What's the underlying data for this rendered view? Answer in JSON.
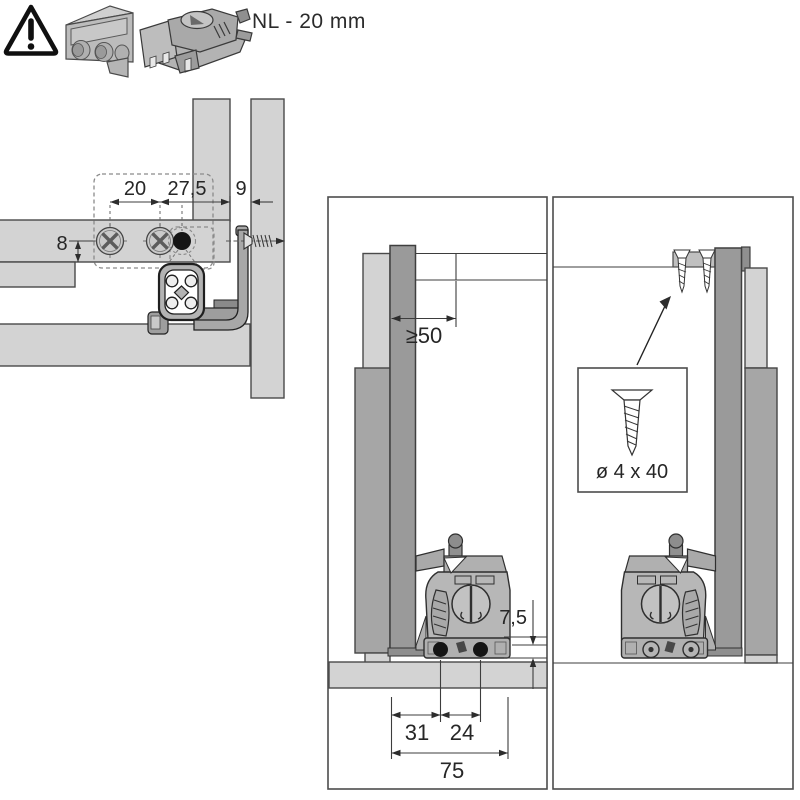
{
  "header": {
    "warning_icon": "warning-triangle",
    "part_icons": [
      "cover-cap-part",
      "locking-device-part"
    ],
    "nl_label": "NL - 20 mm"
  },
  "left_diagram": {
    "dims": {
      "screw_spacing": "20",
      "pin_offset": "27,5",
      "panel_gap": "9",
      "edge_distance": "8"
    }
  },
  "middle_panel": {
    "dims": {
      "min_clearance": "≥50",
      "base_height": "7,5",
      "hole_offset": "31",
      "hole_spacing": "24",
      "total_depth": "75"
    }
  },
  "right_panel": {
    "screw_size_label": "ø 4 x 40"
  },
  "colors": {
    "ink": "#262626",
    "panel_light": "#d3d3d3",
    "panel_dark": "#9a9a9a",
    "hole_fill": "#151515"
  }
}
